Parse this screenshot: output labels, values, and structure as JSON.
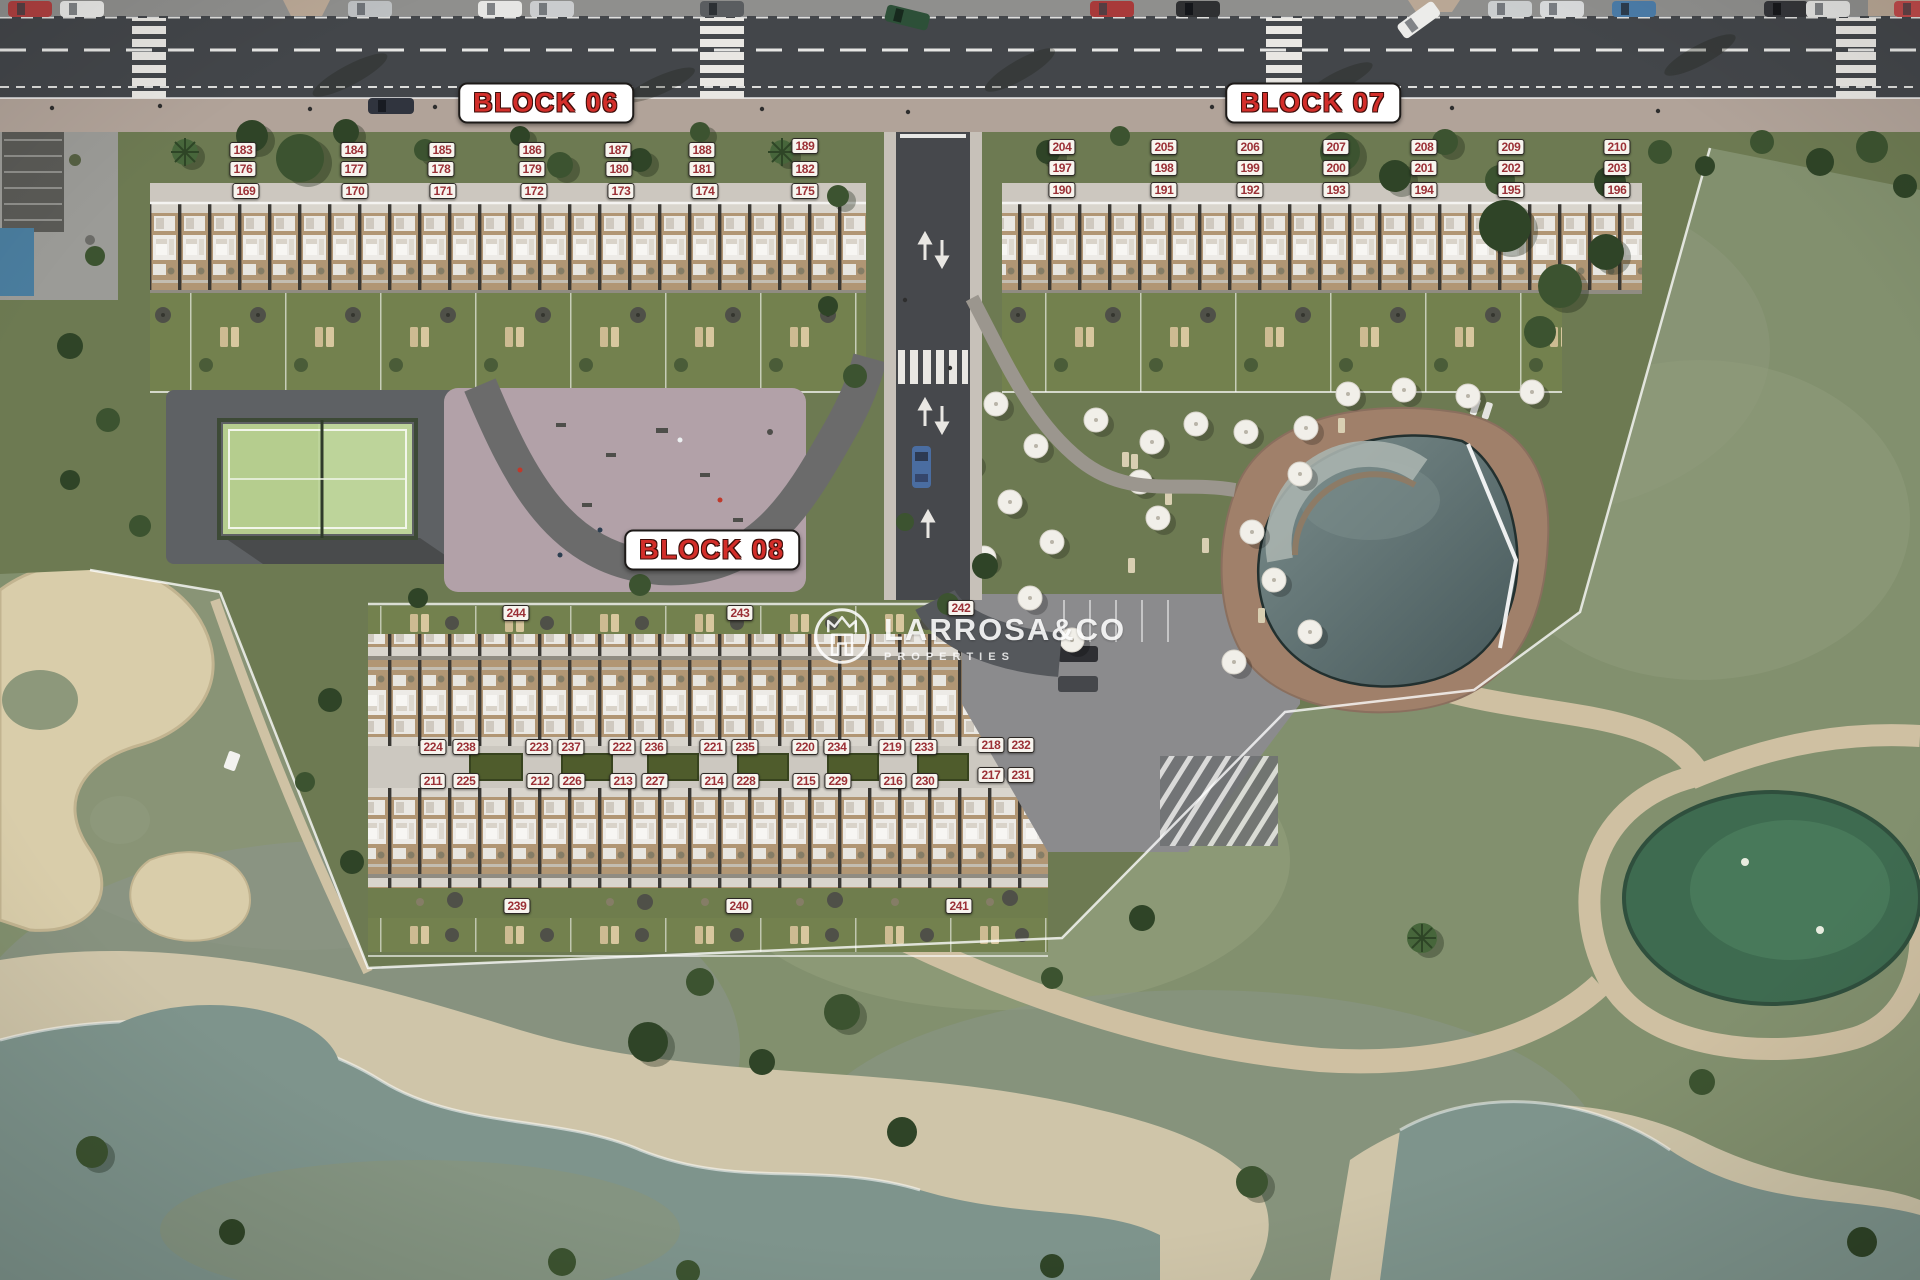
{
  "watermark": {
    "name": "LARROSA&CO",
    "tagline": "PROPERTIES"
  },
  "colors": {
    "unit_label_text": "#9b3036",
    "unit_label_bg": "#f7f4ee",
    "block_title_text": "#d32e2a",
    "block_title_bg": "#ffffff"
  },
  "blocks": [
    {
      "id": "block06",
      "title": "BLOCK 06",
      "title_pos": {
        "x": 546,
        "y": 103
      },
      "units": [
        {
          "n": "183",
          "x": 243,
          "y": 150
        },
        {
          "n": "184",
          "x": 354,
          "y": 150
        },
        {
          "n": "185",
          "x": 442,
          "y": 150
        },
        {
          "n": "186",
          "x": 532,
          "y": 150
        },
        {
          "n": "187",
          "x": 618,
          "y": 150
        },
        {
          "n": "188",
          "x": 702,
          "y": 150
        },
        {
          "n": "189",
          "x": 805,
          "y": 146
        },
        {
          "n": "176",
          "x": 243,
          "y": 169
        },
        {
          "n": "177",
          "x": 354,
          "y": 169
        },
        {
          "n": "178",
          "x": 441,
          "y": 169
        },
        {
          "n": "179",
          "x": 532,
          "y": 169
        },
        {
          "n": "180",
          "x": 619,
          "y": 169
        },
        {
          "n": "181",
          "x": 702,
          "y": 169
        },
        {
          "n": "182",
          "x": 805,
          "y": 169
        },
        {
          "n": "169",
          "x": 246,
          "y": 191
        },
        {
          "n": "170",
          "x": 355,
          "y": 191
        },
        {
          "n": "171",
          "x": 443,
          "y": 191
        },
        {
          "n": "172",
          "x": 534,
          "y": 191
        },
        {
          "n": "173",
          "x": 621,
          "y": 191
        },
        {
          "n": "174",
          "x": 705,
          "y": 191
        },
        {
          "n": "175",
          "x": 805,
          "y": 191
        }
      ]
    },
    {
      "id": "block07",
      "title": "BLOCK 07",
      "title_pos": {
        "x": 1313,
        "y": 103
      },
      "units": [
        {
          "n": "204",
          "x": 1062,
          "y": 147
        },
        {
          "n": "205",
          "x": 1164,
          "y": 147
        },
        {
          "n": "206",
          "x": 1250,
          "y": 147
        },
        {
          "n": "207",
          "x": 1336,
          "y": 147
        },
        {
          "n": "208",
          "x": 1424,
          "y": 147
        },
        {
          "n": "209",
          "x": 1511,
          "y": 147
        },
        {
          "n": "210",
          "x": 1617,
          "y": 147
        },
        {
          "n": "197",
          "x": 1062,
          "y": 168
        },
        {
          "n": "198",
          "x": 1164,
          "y": 168
        },
        {
          "n": "199",
          "x": 1250,
          "y": 168
        },
        {
          "n": "200",
          "x": 1336,
          "y": 168
        },
        {
          "n": "201",
          "x": 1424,
          "y": 168
        },
        {
          "n": "202",
          "x": 1511,
          "y": 168
        },
        {
          "n": "203",
          "x": 1617,
          "y": 168
        },
        {
          "n": "190",
          "x": 1062,
          "y": 190
        },
        {
          "n": "191",
          "x": 1164,
          "y": 190
        },
        {
          "n": "192",
          "x": 1250,
          "y": 190
        },
        {
          "n": "193",
          "x": 1336,
          "y": 190
        },
        {
          "n": "194",
          "x": 1424,
          "y": 190
        },
        {
          "n": "195",
          "x": 1511,
          "y": 190
        },
        {
          "n": "196",
          "x": 1617,
          "y": 190
        }
      ]
    },
    {
      "id": "block08",
      "title": "BLOCK 08",
      "title_pos": {
        "x": 712,
        "y": 550
      },
      "units": [
        {
          "n": "244",
          "x": 516,
          "y": 613
        },
        {
          "n": "243",
          "x": 740,
          "y": 613
        },
        {
          "n": "242",
          "x": 961,
          "y": 608
        },
        {
          "n": "224",
          "x": 433,
          "y": 747
        },
        {
          "n": "238",
          "x": 466,
          "y": 747
        },
        {
          "n": "223",
          "x": 539,
          "y": 747
        },
        {
          "n": "237",
          "x": 571,
          "y": 747
        },
        {
          "n": "222",
          "x": 622,
          "y": 747
        },
        {
          "n": "236",
          "x": 654,
          "y": 747
        },
        {
          "n": "221",
          "x": 713,
          "y": 747
        },
        {
          "n": "235",
          "x": 745,
          "y": 747
        },
        {
          "n": "220",
          "x": 805,
          "y": 747
        },
        {
          "n": "234",
          "x": 837,
          "y": 747
        },
        {
          "n": "219",
          "x": 892,
          "y": 747
        },
        {
          "n": "233",
          "x": 924,
          "y": 747
        },
        {
          "n": "218",
          "x": 991,
          "y": 745
        },
        {
          "n": "232",
          "x": 1021,
          "y": 745
        },
        {
          "n": "211",
          "x": 433,
          "y": 781
        },
        {
          "n": "225",
          "x": 466,
          "y": 781
        },
        {
          "n": "212",
          "x": 540,
          "y": 781
        },
        {
          "n": "226",
          "x": 572,
          "y": 781
        },
        {
          "n": "213",
          "x": 623,
          "y": 781
        },
        {
          "n": "227",
          "x": 655,
          "y": 781
        },
        {
          "n": "214",
          "x": 714,
          "y": 781
        },
        {
          "n": "228",
          "x": 746,
          "y": 781
        },
        {
          "n": "215",
          "x": 806,
          "y": 781
        },
        {
          "n": "229",
          "x": 838,
          "y": 781
        },
        {
          "n": "216",
          "x": 893,
          "y": 781
        },
        {
          "n": "230",
          "x": 925,
          "y": 781
        },
        {
          "n": "217",
          "x": 991,
          "y": 775
        },
        {
          "n": "231",
          "x": 1021,
          "y": 775
        },
        {
          "n": "239",
          "x": 517,
          "y": 906
        },
        {
          "n": "240",
          "x": 739,
          "y": 906
        },
        {
          "n": "241",
          "x": 959,
          "y": 906
        }
      ]
    }
  ]
}
